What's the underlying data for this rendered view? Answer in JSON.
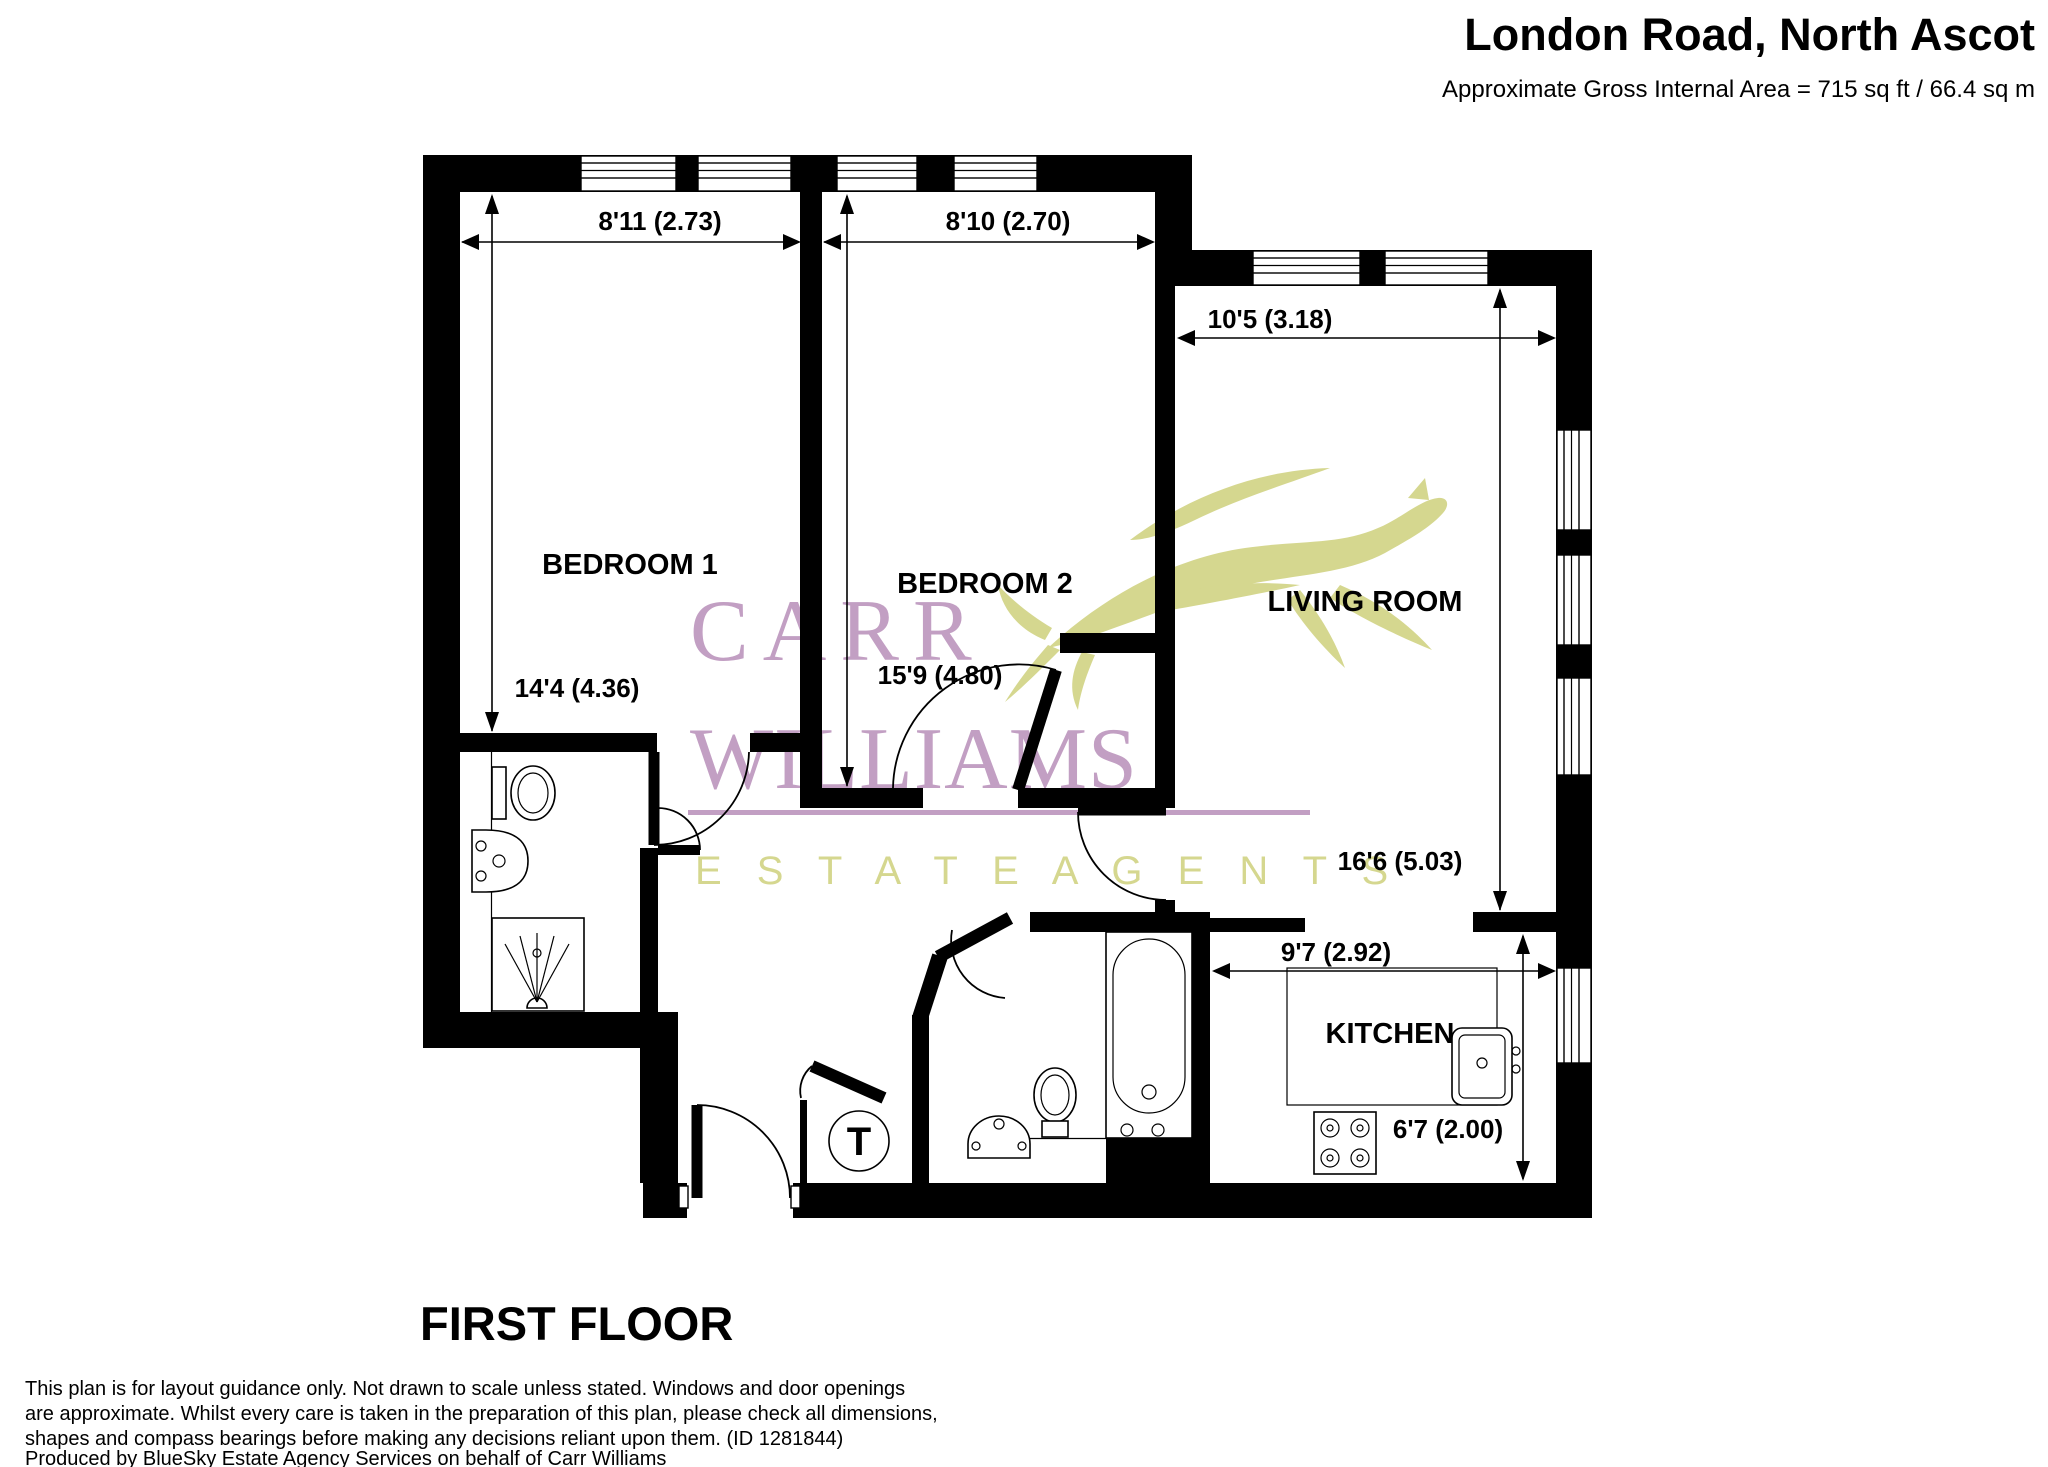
{
  "header": {
    "title": "London Road, North Ascot",
    "subtitle": "Approximate Gross Internal Area = 715 sq ft / 66.4 sq m"
  },
  "plan": {
    "floor_label": "FIRST FLOOR",
    "rooms": [
      {
        "name": "BEDROOM 1",
        "width_label": "8'11 (2.73)",
        "depth_label": "14'4 (4.36)"
      },
      {
        "name": "BEDROOM 2",
        "width_label": "8'10 (2.70)",
        "depth_label": "15'9 (4.80)"
      },
      {
        "name": "LIVING ROOM",
        "width_label": "10'5 (3.18)",
        "depth_label": "16'6 (5.03)"
      },
      {
        "name": "KITCHEN",
        "width_label": "9'7 (2.92)",
        "depth_label": "6'7 (2.00)"
      }
    ],
    "symbols": {
      "water_tank": "T"
    },
    "fixtures": [
      "toilet",
      "wash-basin",
      "shower",
      "bath",
      "kitchen-sink",
      "hob",
      "water-tank"
    ]
  },
  "watermark": {
    "brand_line1": "CARR",
    "brand_line2": "WILLIAMS",
    "brand_line3": "E S T A T E   A G E N T S"
  },
  "disclaimer": {
    "lines": [
      "This plan is for layout guidance only. Not drawn to scale unless stated. Windows and door openings",
      "are approximate. Whilst every care is taken in the preparation of this plan, please check all dimensions,",
      "shapes and compass bearings before making any decisions reliant upon them. (ID 1281844)",
      "Produced by BlueSky Estate Agency Services on behalf of Carr Williams"
    ]
  },
  "colors": {
    "wall": "#000000",
    "watermark_purple": "#c29fc3",
    "watermark_olive": "#d5d78f"
  }
}
